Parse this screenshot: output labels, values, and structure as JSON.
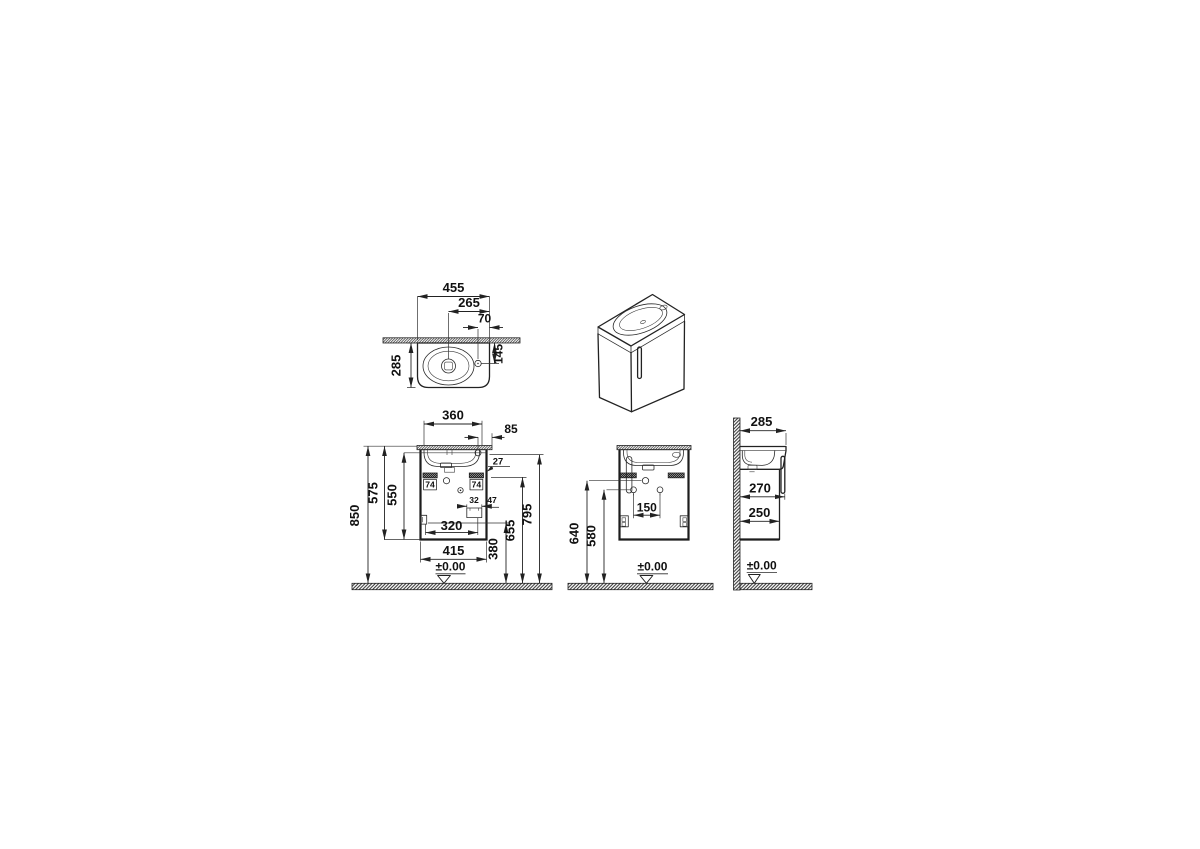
{
  "drawing": {
    "kind": "vanity-unit-dimension-drawing",
    "views": {
      "top": {
        "overall_width": "455",
        "drain_offset": "265",
        "tap_offset": "70",
        "tap_depth": "145",
        "basin_depth": "285"
      },
      "front": {
        "mounting_width": "360",
        "tap_edge_offset": "85",
        "bracket_clearance": "27",
        "bracket_left": "74",
        "bracket_right": "74",
        "outlet_width": "32",
        "outlet_clearance": "47",
        "outlet_offset": "320",
        "cabinet_width": "415",
        "total_height": "850",
        "body_height": "575",
        "door_height": "550",
        "basin_underside_height": "795",
        "bracket_height": "655",
        "outlet_height": "380",
        "floor_datum": "±0.00"
      },
      "rear": {
        "hole_spacing": "150",
        "drain_height": "640",
        "holes_height": "580",
        "floor_datum": "±0.00"
      },
      "side": {
        "total_depth": "285",
        "handle_depth": "270",
        "cabinet_depth": "250",
        "floor_datum": "±0.00"
      }
    }
  }
}
